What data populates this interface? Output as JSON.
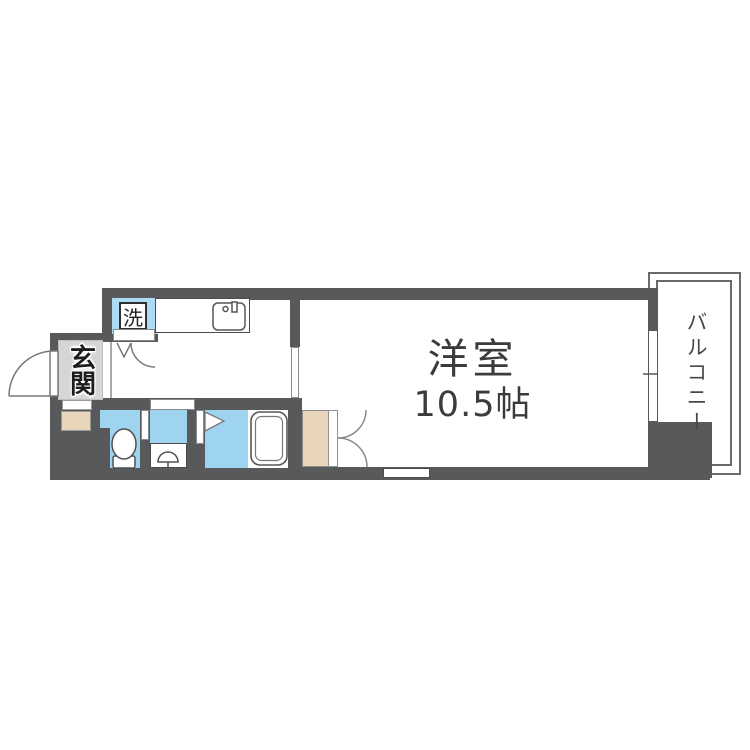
{
  "plan": {
    "entrance_label": "玄関",
    "washer_label": "洗",
    "main_room_label": "洋室",
    "main_room_size": "10.5帖",
    "balcony_label": "バルコニー"
  },
  "colors": {
    "wall": "#58595b",
    "water": "#9ed4f0",
    "water-light": "#aadcf4",
    "beige": "#e8d5ba",
    "tile": "#d6d6d6",
    "outline": "#6a6b6d",
    "room-text": "#3b3b3d"
  }
}
